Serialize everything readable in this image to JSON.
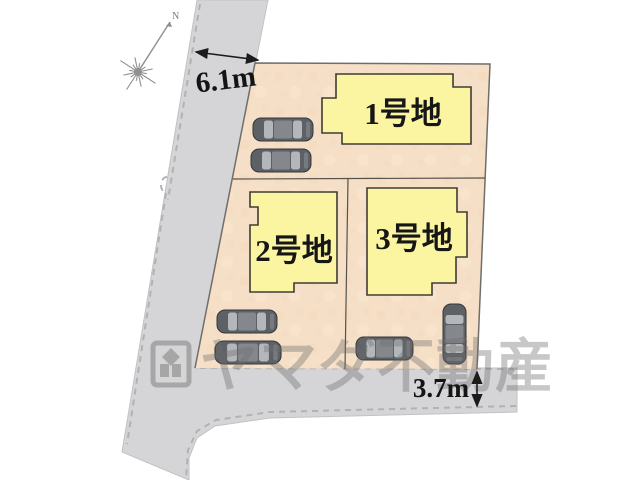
{
  "site_plan": {
    "plots": [
      {
        "label": "1号地"
      },
      {
        "label": "2号地"
      },
      {
        "label": "3号地"
      }
    ],
    "dimensions": {
      "road_width_top": "6.1m",
      "road_width_bottom": "3.7m"
    },
    "compass": {
      "north_label": "N"
    },
    "watermark": {
      "company": "ヤマダ不動産"
    },
    "counts": {
      "parked_cars": 6
    },
    "colors": {
      "road": "#d5d5d7",
      "parcel": "#f6dfc7",
      "house_fill": "#fbf4a1",
      "house_border": "#3e3d35",
      "watermark_gray": "#6f6f6f"
    }
  }
}
